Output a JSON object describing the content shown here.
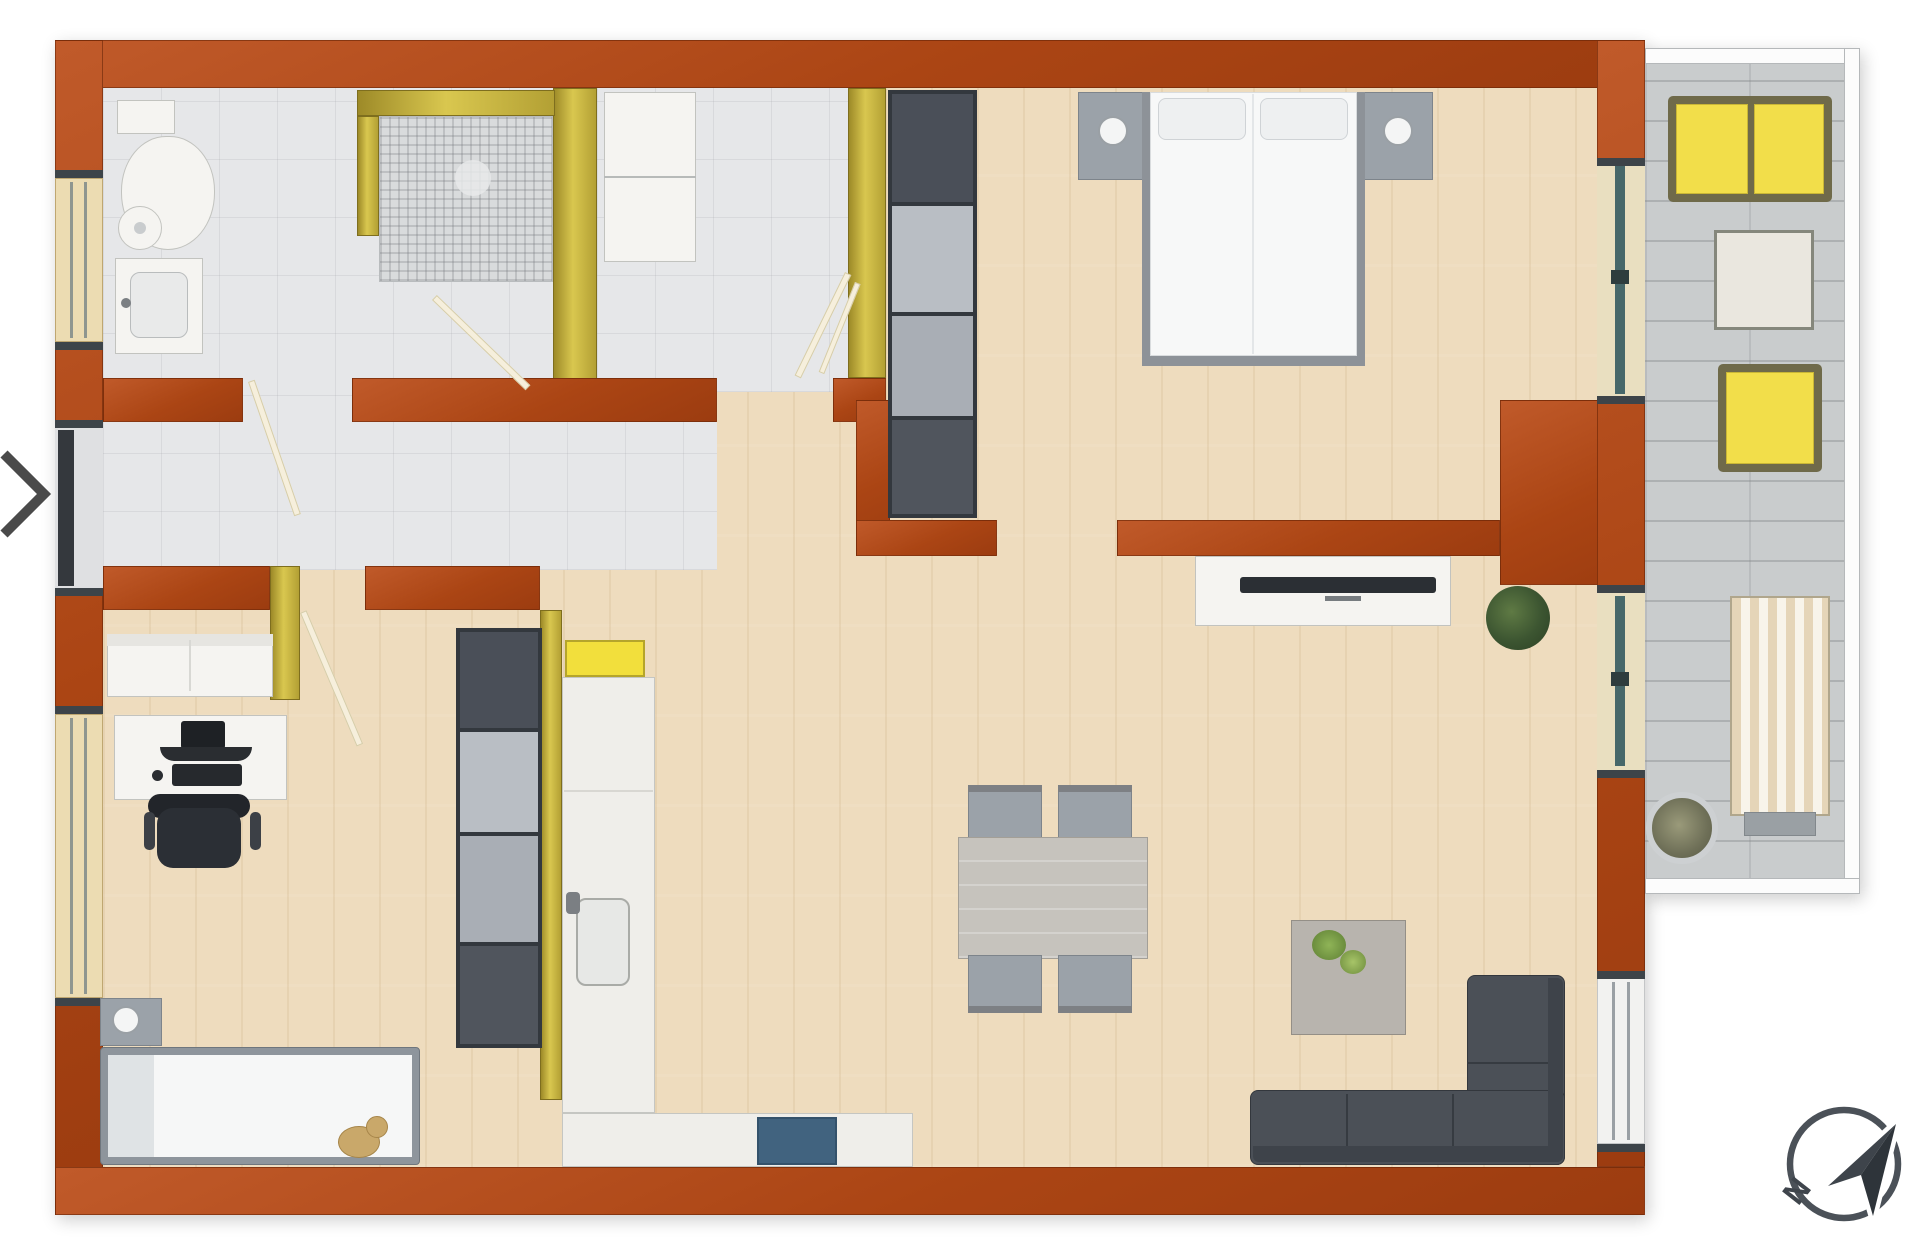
{
  "compass": {
    "label": "N",
    "pointing": "northeast"
  },
  "carousel": {
    "next_button": "chevron-right"
  },
  "palette": {
    "wall_terracotta": "#ab4514",
    "gold_trim": "#d9c74f",
    "wood_floor": "#eedcbe",
    "tile_floor": "#e6e7e9",
    "balcony_paver": "#c9cccd",
    "accent_yellow": "#f2de4a",
    "dark_sofa": "#4b5057",
    "glass_teal": "#47686a",
    "kitchen_blue": "#41637f",
    "compass_gray": "#3f454c"
  },
  "floorplan": {
    "type": "apartment-top-view-3d-render",
    "rooms": [
      {
        "name": "bathroom",
        "floor": "gray-tile",
        "items": [
          "toilet",
          "bidet",
          "washbasin-vanity",
          "mosaic-shower"
        ]
      },
      {
        "name": "dressing-corridor",
        "floor": "gray-tile",
        "items": [
          "white-wardrobe",
          "tall-shelving-unit"
        ]
      },
      {
        "name": "hallway",
        "floor": "gray-tile",
        "items": [
          "entry-door"
        ]
      },
      {
        "name": "bedroom",
        "floor": "wood",
        "items": [
          "double-bed",
          "pillow-left",
          "pillow-right",
          "nightstand-left",
          "nightstand-right",
          "tv-sideboard",
          "floor-plant",
          "balcony-slider"
        ]
      },
      {
        "name": "living-dining",
        "floor": "wood",
        "items": [
          "dining-table",
          "dining-chairs-x4",
          "corner-sofa",
          "coffee-table",
          "flower-bouquet",
          "window"
        ]
      },
      {
        "name": "kitchen",
        "floor": "wood",
        "items": [
          "l-shaped-counter",
          "sink",
          "cooktop-panel",
          "tall-shelving-unit",
          "blue-appliance"
        ]
      },
      {
        "name": "kids-office-room",
        "floor": "wood",
        "items": [
          "single-bed",
          "teddy-bear",
          "nightstand-lamp",
          "desk",
          "monitor",
          "keyboard",
          "mouse",
          "office-chair",
          "white-loveseat",
          "window"
        ]
      },
      {
        "name": "balcony",
        "floor": "stone-pavers",
        "items": [
          "yellow-sofa",
          "side-table",
          "yellow-armchair",
          "sun-lounger",
          "potted-plant",
          "railing"
        ]
      }
    ]
  }
}
